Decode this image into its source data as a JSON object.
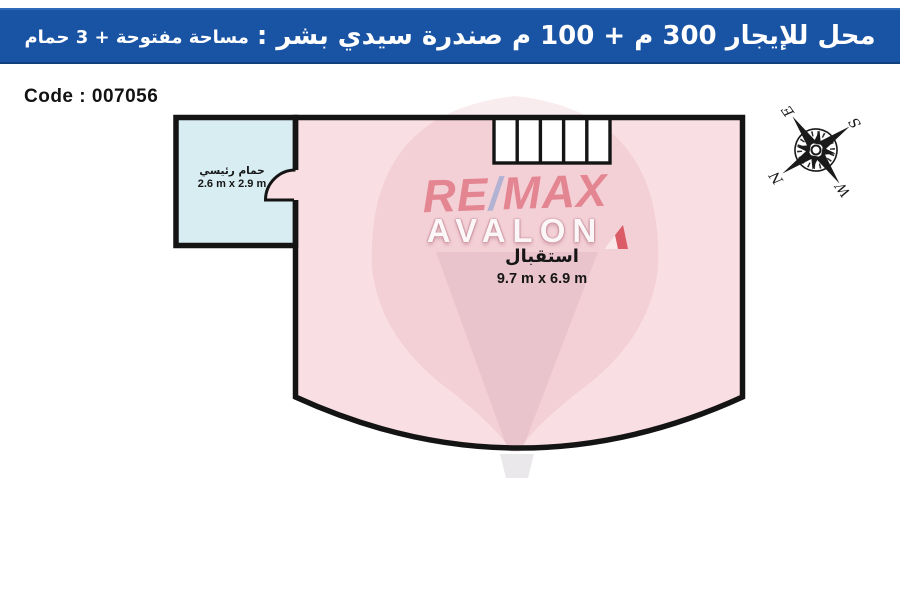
{
  "header": {
    "title_primary": "محل للإيجار 300 م + 100 م صندرة سيدي بشر :",
    "title_secondary": "مساحة مفتوحة + 3 حمام",
    "bg_color": "#1953a4",
    "text_color": "#ffffff"
  },
  "listing": {
    "code_label": "Code : 007056"
  },
  "floor_plan": {
    "wall_color": "#141414",
    "stairs_steps": 5,
    "rooms": [
      {
        "name": "حمام رئيسي",
        "dimensions": "2.6 m x 2.9 m",
        "fill": "#d7edf2"
      },
      {
        "name": "استقبال",
        "dimensions": "9.7 m x 6.9 m",
        "fill": "#f9dee3"
      }
    ]
  },
  "compass": {
    "north": "N",
    "east": "E",
    "south": "S",
    "west": "W"
  },
  "watermark": {
    "line1_part1": "RE",
    "line1_slash": "/",
    "line1_part2": "MAX",
    "line2": "AVALON",
    "red_color": "#d84a5b",
    "blue_color": "#7d9ccf"
  }
}
